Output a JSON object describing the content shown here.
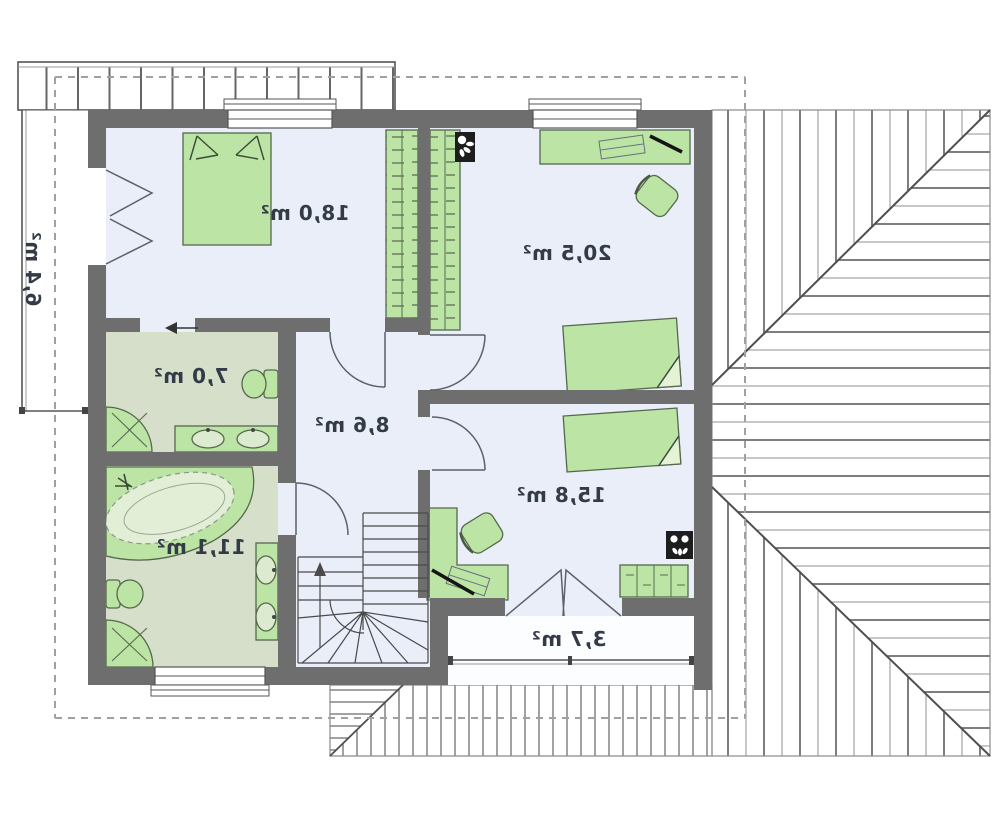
{
  "plan": {
    "type": "attic-floor-plan-mirrored",
    "rooms": [
      {
        "id": "bedroom-1",
        "area_label": "18,0 m²",
        "area_m2": 18.0,
        "floor": "room"
      },
      {
        "id": "bedroom-2",
        "area_label": "20,5 m²",
        "area_m2": 20.5,
        "floor": "room"
      },
      {
        "id": "bathroom-small",
        "area_label": "7,0 m²",
        "area_m2": 7.0,
        "floor": "bathroom"
      },
      {
        "id": "hall",
        "area_label": "8,6 m²",
        "area_m2": 8.6,
        "floor": "room"
      },
      {
        "id": "bedroom-3",
        "area_label": "15,8 m²",
        "area_m2": 15.8,
        "floor": "room"
      },
      {
        "id": "bathroom-large",
        "area_label": "11,1 m²",
        "area_m2": 11.1,
        "floor": "bathroom"
      },
      {
        "id": "balcony-rear",
        "area_label": "3,7 m²",
        "area_m2": 3.7,
        "floor": "balcony"
      },
      {
        "id": "balcony-side",
        "area_label": "6,4 m²",
        "area_m2": 6.4,
        "floor": "balcony"
      }
    ],
    "icons": [
      "double-bed-icon",
      "single-bed-icon",
      "wardrobe-icon",
      "desk-icon",
      "office-chair-icon",
      "dresser-icon",
      "bathtub-icon",
      "corner-shower-icon",
      "toilet-icon",
      "washbasin-icon",
      "winder-staircase-icon",
      "flue-icon",
      "balcony-railing-icon",
      "roof-hatch-icon",
      "door-swing-icon",
      "sliding-door-arrow-icon",
      "window-icon"
    ],
    "colors": {
      "wall": "#6e6e6e",
      "room_floor": "#e9eef8",
      "bathroom_floor": "#d6dfca",
      "furniture_fill": "#bce4a4",
      "furniture_border": "#55684d",
      "line": "#555555",
      "dashed_eave": "#a0a0a0",
      "text": "#333b46"
    }
  }
}
